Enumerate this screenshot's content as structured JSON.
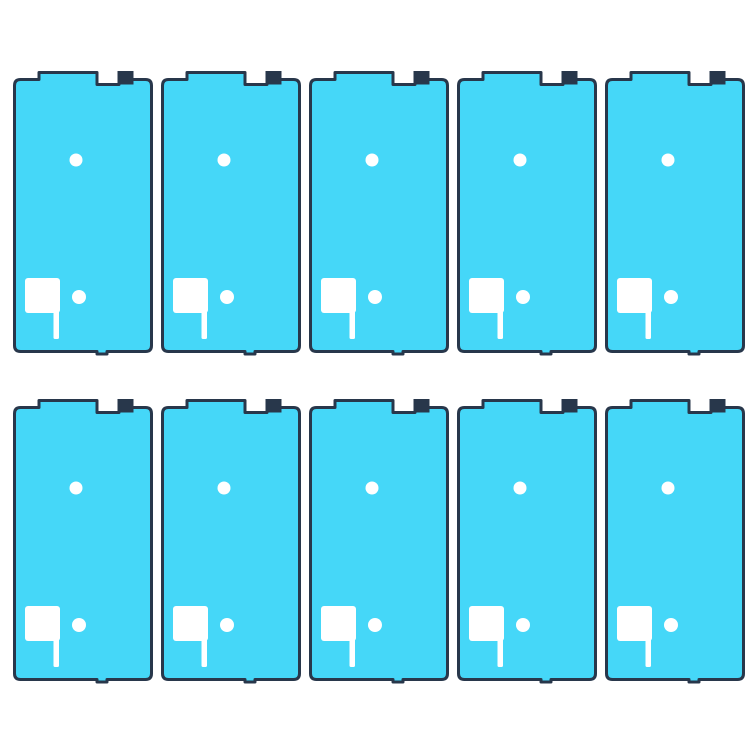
{
  "canvas": {
    "width": 750,
    "height": 750,
    "background_color": "#ffffff"
  },
  "product": {
    "item_count": 10,
    "item_kind": "phone-front-housing-adhesive-sticker"
  },
  "grid": {
    "rows": 2,
    "cols": 5,
    "left": 13,
    "top": 71,
    "col_gap": 8,
    "row_gap": 46,
    "item_width": 140,
    "item_height": 282
  },
  "sticker": {
    "fill_color": "#45d7f8",
    "outline_color": "#28374b",
    "cutout_color": "#ffffff",
    "outline_width": 3,
    "corner_radius": 6,
    "top_profile": {
      "tab_start": 26,
      "tab_end": 84,
      "notch_end": 106,
      "small_tab_end": 119,
      "base_top": 7,
      "notch_depth": 12
    },
    "bottom_tab": {
      "start": 84,
      "end": 94,
      "depth": 2.5
    },
    "cutouts": {
      "upper_hole": {
        "cx": 63,
        "cy": 89,
        "r": 6.5
      },
      "lower_hole": {
        "cx": 66,
        "cy": 226,
        "r": 7
      },
      "flag": {
        "x": 12,
        "y": 207,
        "width": 35,
        "height": 35,
        "radius": 3
      },
      "flag_stem": {
        "x": 40.5,
        "y": 238,
        "width": 5.5,
        "bottom": 268
      }
    }
  }
}
